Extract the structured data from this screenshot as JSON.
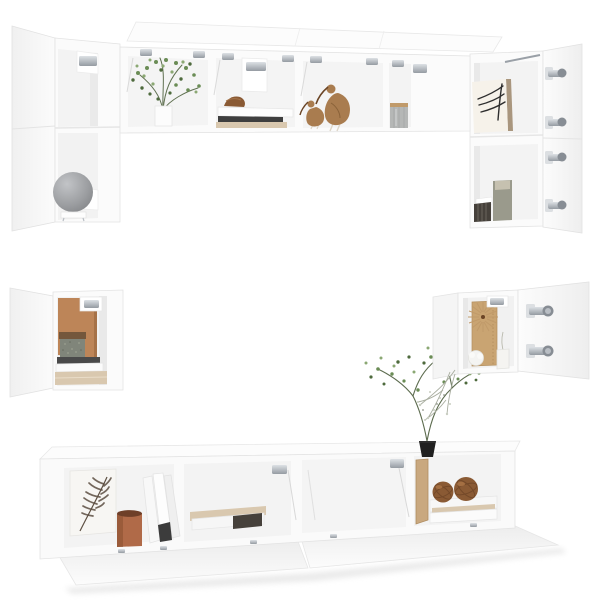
{
  "meta": {
    "description": "Product photo: 6-piece white wall-mounted TV cabinet set with open doors and flip-up lids, styled with decor props on a pure white studio background",
    "width": 600,
    "height": 600
  },
  "palette": {
    "background": "#ffffff",
    "carcass": "#fbfbfb",
    "interior": "#f3f3f3",
    "edge": "#e3e3e3",
    "plant_green": "#6a8c55",
    "plant_green_dark": "#4e6a3d",
    "plant_green_light": "#8ba873",
    "wood_tan": "#a97c4f",
    "wood_dark": "#6b4526",
    "terracotta": "#bd8558",
    "copper": "#b06a48",
    "copper_dark": "#6e3f28",
    "stone_gray": "#80857a",
    "stone_rim": "#74573c",
    "lamp_gray": "#9b9da0",
    "rattan": "#8a5a34",
    "rattan_dark": "#6d4426",
    "beige": "#d9c8af",
    "dark_book": "#46413b",
    "black_pot": "#202020",
    "canister_gray": "#b5b7b6",
    "canister_rim": "#c09a6a",
    "art_ink": "#2e2e2e",
    "frame_wood": "#a9967e",
    "olive_vase": "#9a9a8c",
    "sprig_gray": "#a8ad9f",
    "feather_dark": "#5d4f42",
    "cream": "#f6f2ea",
    "chrome": "#b9bec4",
    "chrome_dark": "#878d94"
  },
  "pieces": [
    {
      "name": "tall-wall-cabinet-left",
      "label": "Tall wall cabinet, left, door open, globe lamp inside"
    },
    {
      "name": "wall-shelf-long",
      "label": "Long wall shelf with flip-up lids open: plant, shell, bird figurines, jar"
    },
    {
      "name": "tall-wall-cabinet-right",
      "label": "Tall wall cabinet, right, door open, botanical print and vase inside"
    },
    {
      "name": "small-wall-cabinet-left",
      "label": "Small wall cabinet, left, door open, stone pot on books"
    },
    {
      "name": "small-wall-cabinet-right",
      "label": "Small wall cabinet, right, door open, wooden sunburst decor"
    },
    {
      "name": "tv-stand-long",
      "label": "Long TV stand with flip-down doors open and potted plant on top"
    }
  ],
  "props": {
    "globe_lamp": {
      "label": "Gray globe lamp on small stand"
    },
    "shelf_plant": {
      "label": "Green plant in white vase"
    },
    "shell_decor": {
      "label": "Brown shell decor on shelf stack"
    },
    "wooden_birds": {
      "label": "Two wooden bird figurines"
    },
    "storage_jar": {
      "label": "Gray ribbed storage jar with wooden lid rim"
    },
    "botanical_print": {
      "label": "Framed botanical print"
    },
    "vase_books": {
      "label": "Olive vase and dark book stack"
    },
    "terracotta_board": {
      "label": "Terracotta board backdrop"
    },
    "stone_pot": {
      "label": "Speckled stone pot on book stack"
    },
    "sunburst": {
      "label": "Wooden sunburst decor on tan board"
    },
    "pompom_candle": {
      "label": "White pompom and pillar candle"
    },
    "dried_sprig": {
      "label": "Dried flower sprig"
    },
    "feather_print": {
      "label": "Feather art print"
    },
    "copper_pot": {
      "label": "Copper cylinder pot"
    },
    "folders": {
      "label": "Leaning white folders"
    },
    "book_stack": {
      "label": "Beige and brown book stack"
    },
    "wood_panel": {
      "label": "Leaning wooden panel"
    },
    "rattan_balls": {
      "label": "Two rattan deco balls on books"
    },
    "bonsai": {
      "label": "Delicate green plant in black pot"
    }
  }
}
